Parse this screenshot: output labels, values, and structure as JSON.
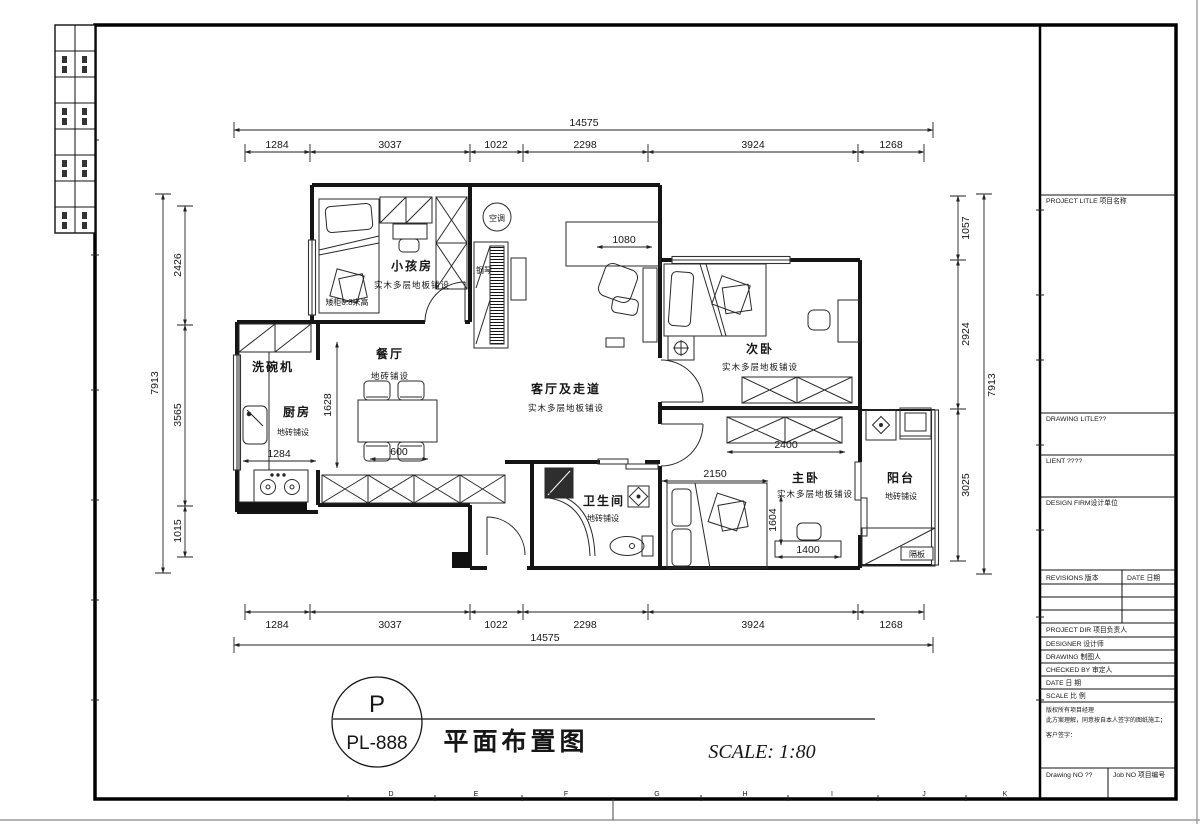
{
  "sheet": {
    "code_letter": "P",
    "number": "PL-888",
    "title": "平面布置图",
    "scale_note": "SCALE: 1:80"
  },
  "title_block": {
    "project_title": "PROJECT LITLE 项目名称",
    "drawing_title": "DRAWING LITLE??",
    "client": "LIENT ????",
    "design_firm": "DESIGN FIRM设计单位",
    "revisions": "REVISIONS 版本",
    "revisions_date": "DATE 日期",
    "rows": [
      "PROJECT DIR 项目负责人",
      "DESIGNER 设计师",
      "DRAWING 制图人",
      "CHECKED BY 审定人",
      "DATE 日 期",
      "SCALE 比 例"
    ],
    "copyright_lines": [
      "版权所有项目经理",
      "此方案理解，同意按自本人签字的图纸施工；",
      "客户签字："
    ],
    "drawing_no": "Drawing NO ??",
    "job_no": "Job NO 项目编号"
  },
  "grid_letters": [
    "D",
    "E",
    "F",
    "G",
    "H",
    "I",
    "J",
    "K"
  ],
  "plan": {
    "rooms": {
      "kids": {
        "name": "小孩房",
        "floor": "实木多层地板铺设"
      },
      "dining": {
        "name": "餐厅",
        "floor": "地砖铺设"
      },
      "kitchen": {
        "name": "厨房",
        "floor": "地砖铺设"
      },
      "living": {
        "name": "客厅及走道",
        "floor": "实木多层地板铺设"
      },
      "second_bedroom": {
        "name": "次卧",
        "floor": "实木多层地板铺设"
      },
      "master_bedroom": {
        "name": "主卧",
        "floor": "实木多层地板铺设"
      },
      "bathroom": {
        "name": "卫生间",
        "floor": "地砖铺设"
      },
      "balcony": {
        "name": "阳台",
        "floor": "地砖铺设"
      }
    },
    "labels": {
      "dishwasher": "洗碗机",
      "ac": "空调",
      "piano": "钢琴",
      "low_cabinet": "矮柜0.8米高",
      "partition": "隔板"
    }
  },
  "dims": {
    "top": {
      "total": "14575",
      "segments": [
        "1284",
        "3037",
        "1022",
        "2298",
        "3924",
        "1268"
      ]
    },
    "bottom": {
      "total": "14575",
      "segments": [
        "1284",
        "3037",
        "1022",
        "2298",
        "3924",
        "1268"
      ]
    },
    "left": {
      "total": "7913",
      "segments": [
        "2426",
        "3565",
        "1015"
      ]
    },
    "right": {
      "total": "7913",
      "segments": [
        "1057",
        "2924",
        "3025"
      ]
    },
    "interior": {
      "dining_depth": "1628",
      "living_table": "1080",
      "dining_table": "600",
      "kitchen": "1284",
      "wardrobe": "2400",
      "master_width": "2150",
      "master_desk_depth": "1604",
      "master_desk_width": "1400"
    }
  }
}
